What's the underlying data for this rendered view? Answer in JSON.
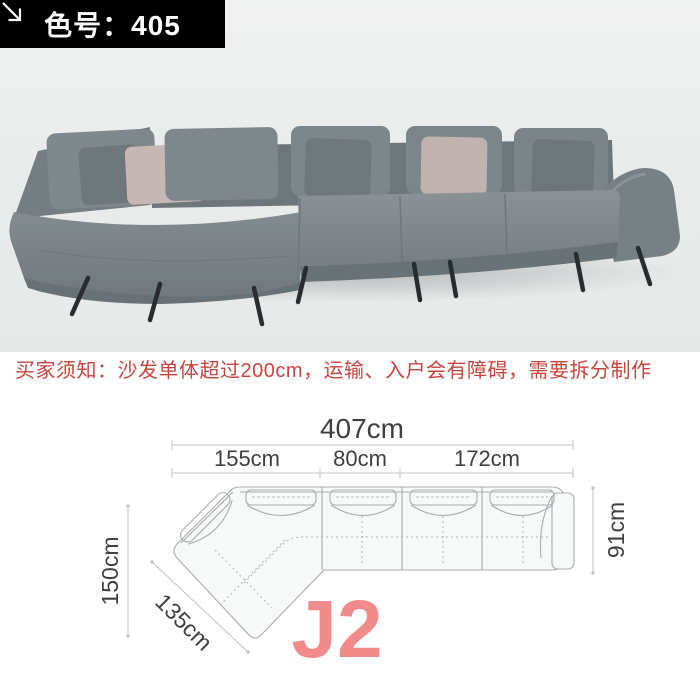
{
  "badge": {
    "label": "色号：405",
    "arrow_icon": "arrow-down-right"
  },
  "notice": {
    "text": "买家须知：沙发单体超过200cm，运输、入户会有障碍，需要拆分制作"
  },
  "photo": {
    "subject": "gray L-shaped sectional fabric sofa with throw pillows",
    "sofa_color": "#7d868a",
    "pillow_accent_color": "#c7b7b4"
  },
  "diagram": {
    "model_label": "J2",
    "total_width": "407cm",
    "sections": [
      "155cm",
      "80cm",
      "172cm"
    ],
    "left_depth": "150cm",
    "chaise_length": "135cm",
    "right_depth": "91cm"
  },
  "colors": {
    "badge-bg": "#000000",
    "badge-text": "#ffffff",
    "notice-red": "#c9453f",
    "model-pink": "#f28b8b",
    "dim-text": "#3d4144",
    "dim-line": "#c0c4c6",
    "plan-line": "#a8adb0"
  }
}
